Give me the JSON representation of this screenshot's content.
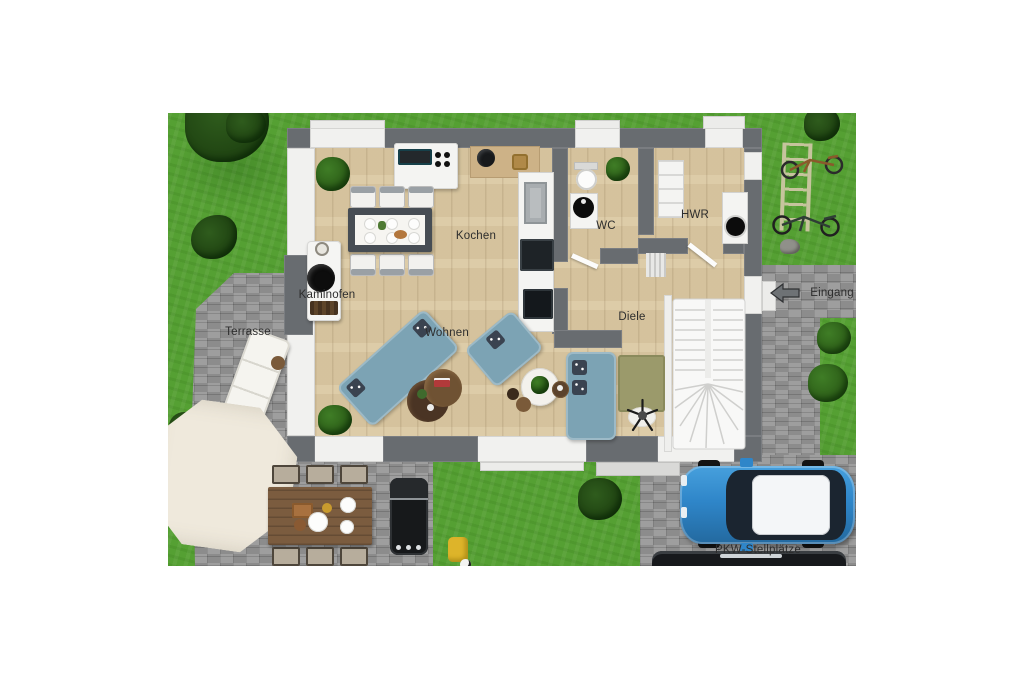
{
  "plan": {
    "labels": {
      "kochen": "Kochen",
      "wc": "WC",
      "hwr": "HWR",
      "kaminofen": "Kaminofen",
      "wohnen": "Wohnen",
      "diele": "Diele",
      "terrasse": "Terrasse",
      "eingang": "Eingang",
      "pkw_stellplaetze": "PKW-Stellplätze"
    },
    "colors": {
      "grass": "#55a033",
      "pavement": "#979797",
      "wall_dark": "#686c70",
      "wall_light": "#f1f1ef",
      "wood_floor": "#dbc9a3",
      "sofa_blue": "#7ca3b4",
      "car_blue": "#2f86c9",
      "parasol_cream": "#efe9dc",
      "rug_olive": "#9b9a6b",
      "label_text": "#2d2d2d"
    }
  }
}
